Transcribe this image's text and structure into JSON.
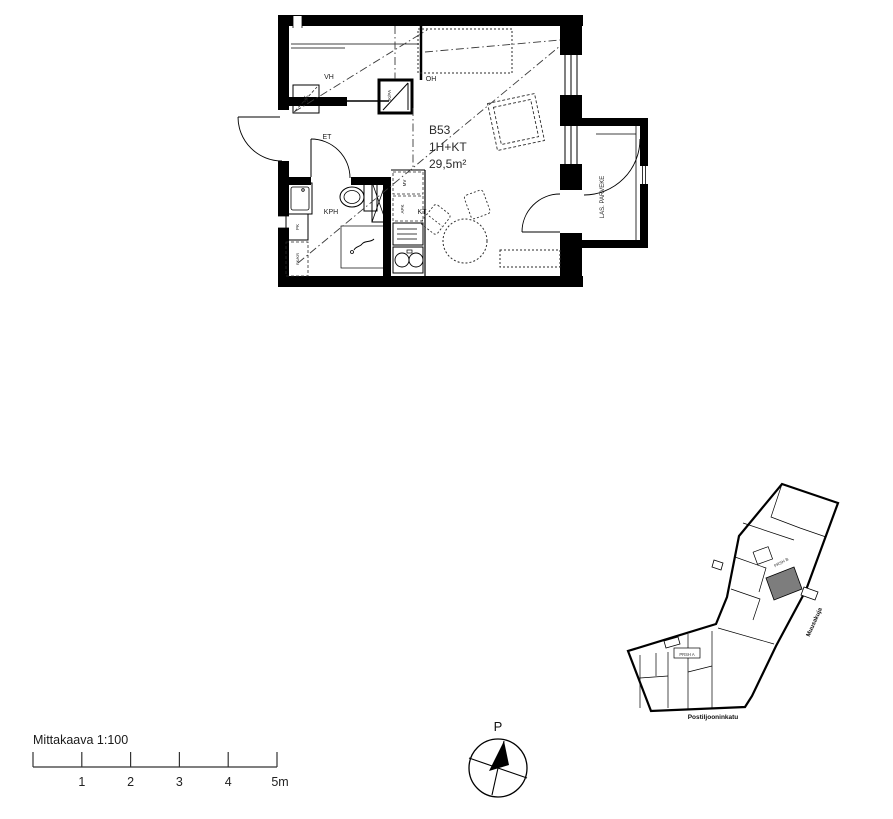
{
  "colors": {
    "line": "#000000",
    "text": "#222222",
    "highlight_unit": "#7d7d7d",
    "background": "#ffffff"
  },
  "floorplan": {
    "apartment": {
      "id": "B53",
      "type": "1H+KT",
      "area": "29,5m²"
    },
    "rooms": {
      "hall": "ET",
      "closet": "VH",
      "cleaning_closet": "SK",
      "bathroom": "KPH",
      "living_room": "OH",
      "kitchenette": "KT",
      "balcony": "LAS. PARVEKE"
    },
    "appliances": {
      "fridge_freezer": "JK/PA",
      "washing_machine": "PK",
      "washer_dryer_reserve": "PK/KR",
      "microwave_reserve": "MV",
      "dishwasher_reserve": "APK"
    }
  },
  "siteplan": {
    "staircase_b": "PRSH B",
    "staircase_a": "PRSH A",
    "street_side": "Muusakuja",
    "street_bottom": "Postiljooninkatu"
  },
  "compass": {
    "north": "P"
  },
  "scalebar": {
    "label": "Mittakaava 1:100",
    "ticks": [
      "1",
      "2",
      "3",
      "4",
      "5m"
    ]
  }
}
